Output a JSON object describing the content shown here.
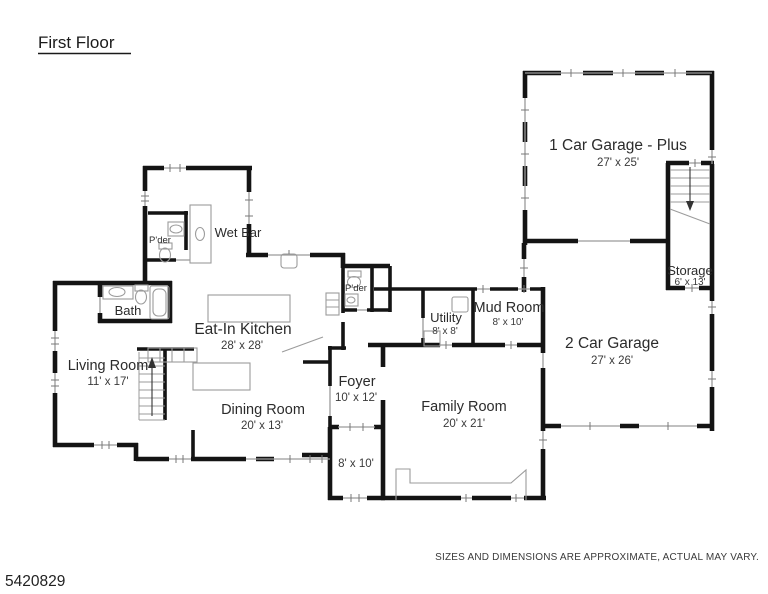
{
  "title": "First Floor",
  "watermark": "5420829",
  "disclaimer": "SIZES AND DIMENSIONS ARE APPROXIMATE, ACTUAL MAY VARY.",
  "colors": {
    "wall": "#141414",
    "window": "#9a9a9a",
    "fixture": "#9b9b9b",
    "background": "#ffffff"
  },
  "rooms": {
    "garage1": {
      "name": "1 Car Garage - Plus",
      "dims": "27' x 25'"
    },
    "garage2": {
      "name": "2 Car Garage",
      "dims": "27' x 26'"
    },
    "storage": {
      "name": "Storage",
      "dims": "6' x 13'"
    },
    "kitchen": {
      "name": "Eat-In Kitchen",
      "dims": "28' x 28'"
    },
    "wetbar": {
      "name": "Wet Bar"
    },
    "powder1": {
      "name": "P'der"
    },
    "powder2": {
      "name": "P'der"
    },
    "bath": {
      "name": "Bath"
    },
    "living": {
      "name": "Living Room",
      "dims": "11' x 17'"
    },
    "dining": {
      "name": "Dining Room",
      "dims": "20' x 13'"
    },
    "foyer": {
      "name": "Foyer",
      "dims": "10' x 12'"
    },
    "porch": {
      "dims": "8' x 10'"
    },
    "family": {
      "name": "Family Room",
      "dims": "20' x 21'"
    },
    "utility": {
      "name": "Utility",
      "dims": "8' x 8'"
    },
    "mudroom": {
      "name": "Mud Room",
      "dims": "8' x 10'"
    }
  }
}
